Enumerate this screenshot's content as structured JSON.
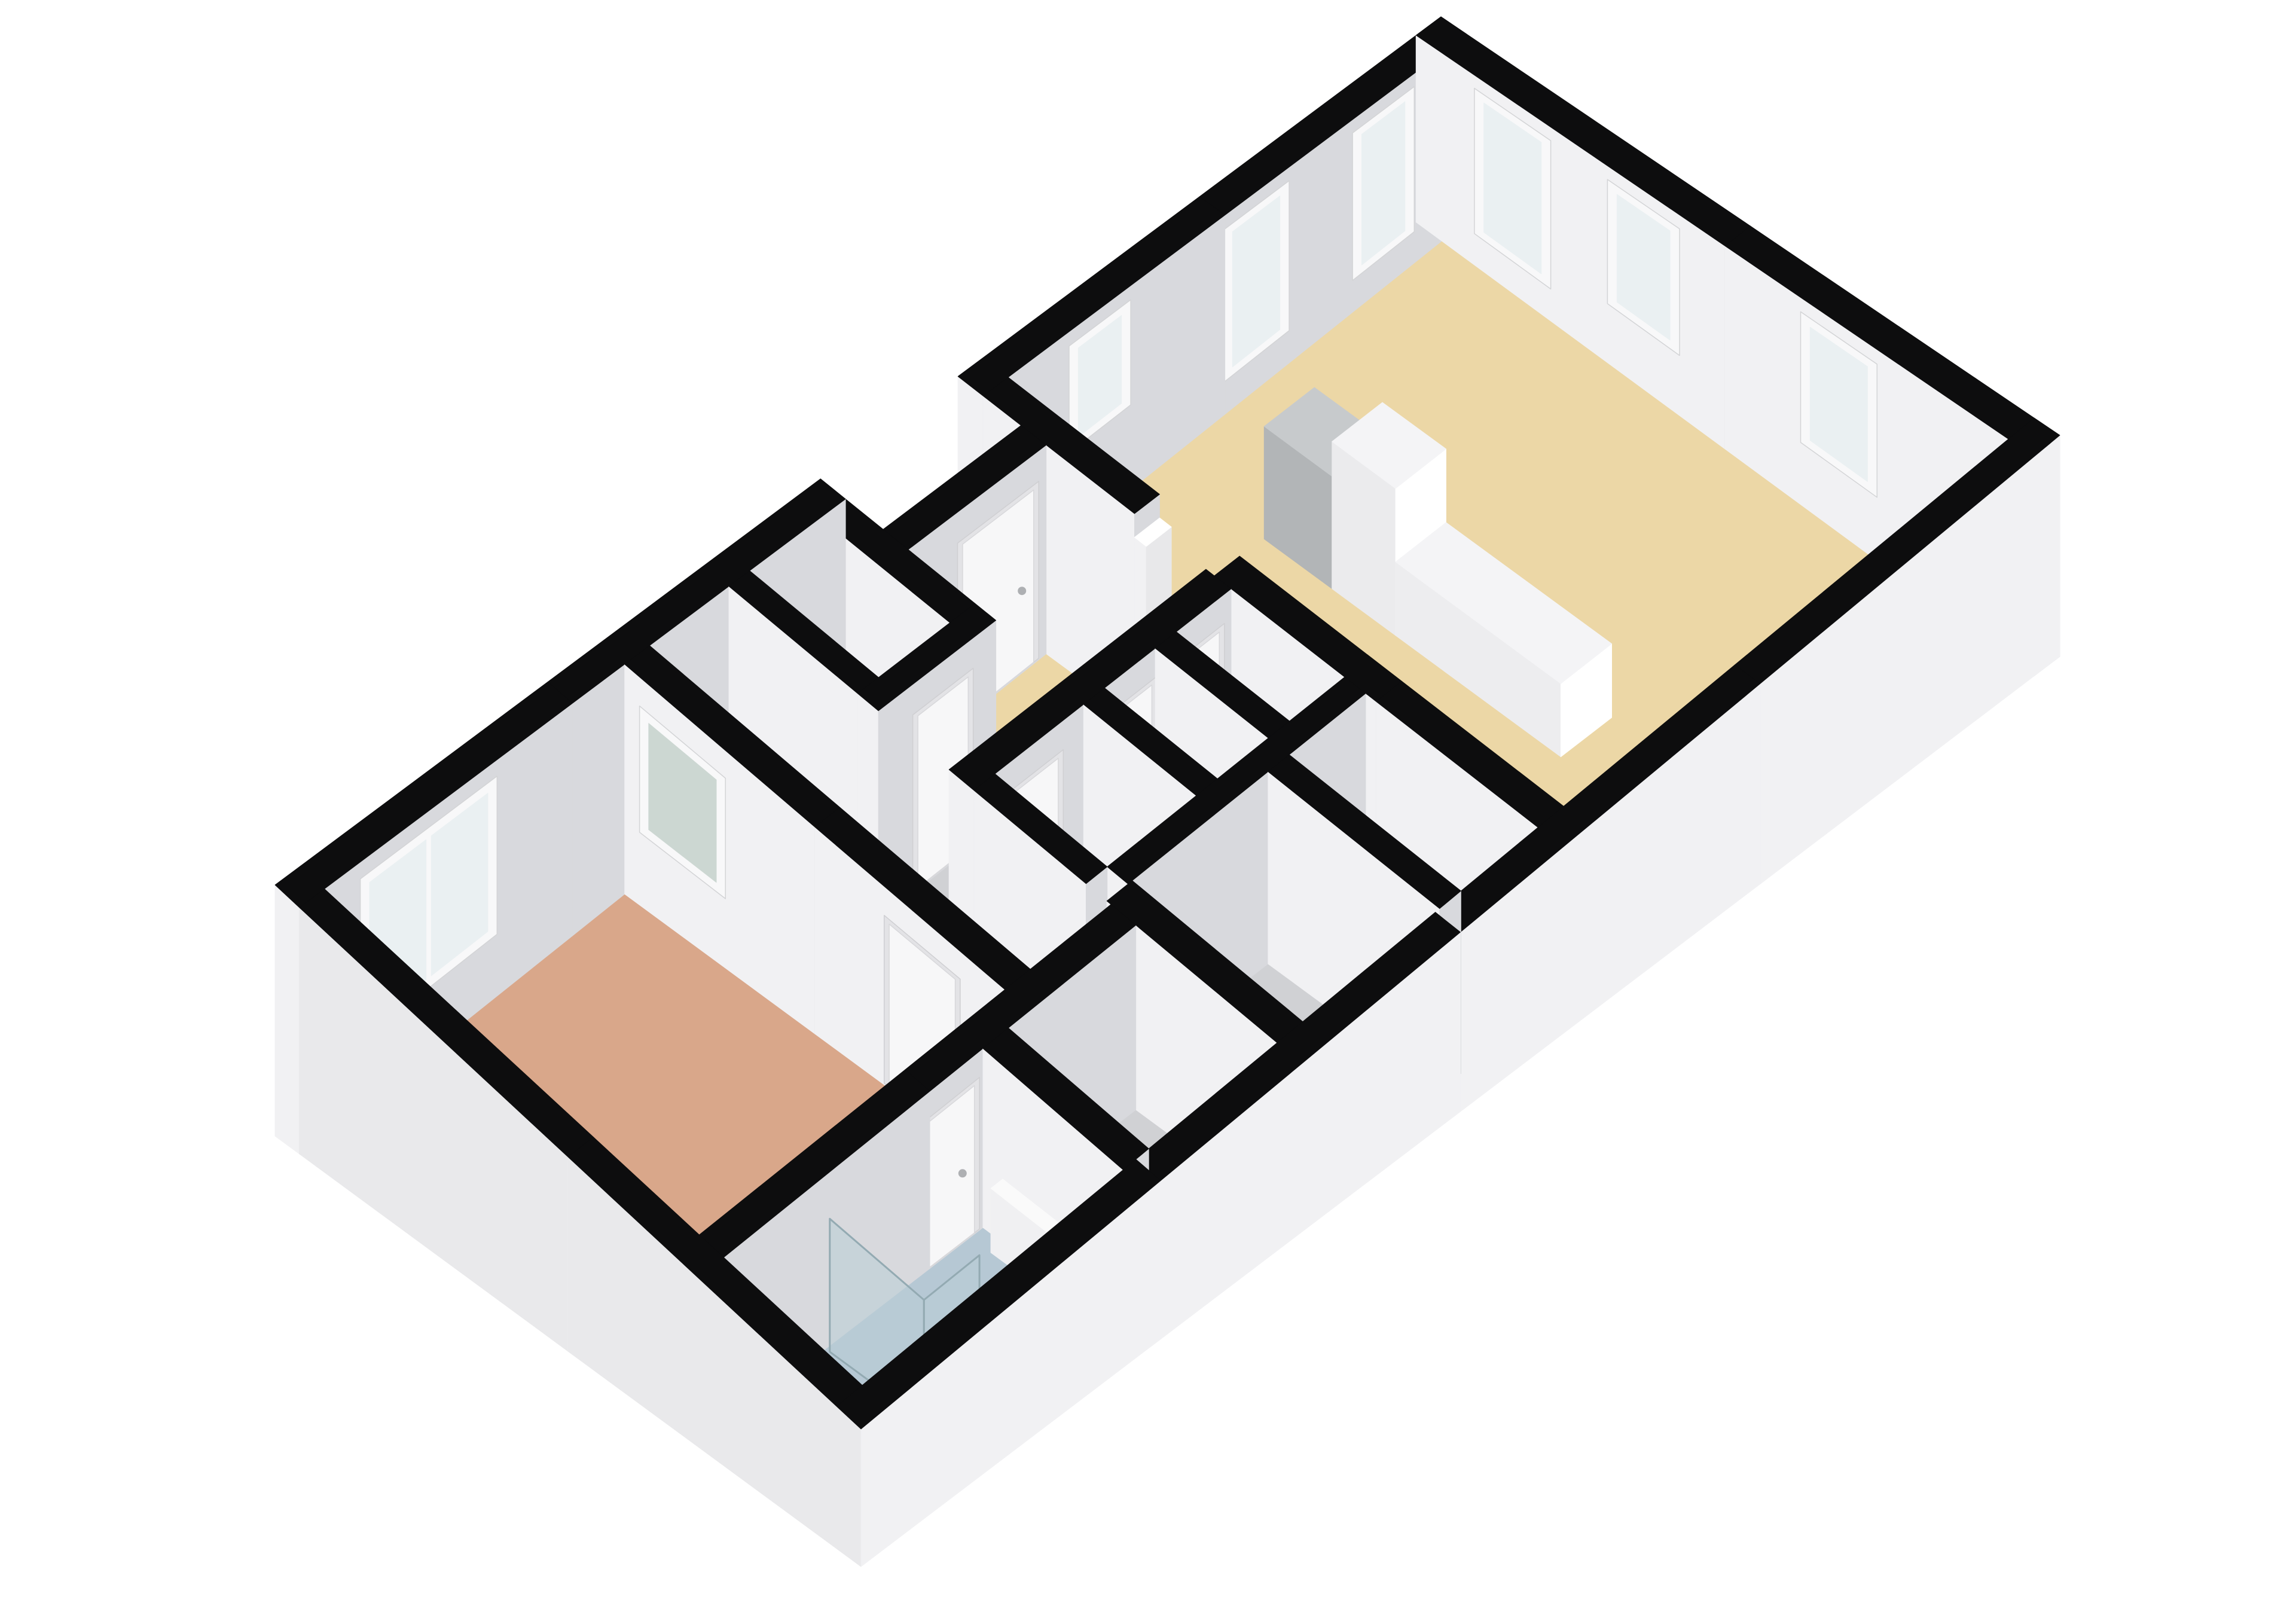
{
  "floorplan": {
    "description": "3D isometric floor plan of an apartment, viewed from above. Black wall tops, white interior walls, light gray exterior wall faces on a white background. Large living room with beige floor, kitchen counter units and five windows; entry hall with beige floor behind a recessed front-door notch; central cluster of gray-floored rooms (hallway, toilet, storage, boiler closet with two orange control knobs); bathroom with light blue floor, glass shower screen, toilet and white radiator; bedroom with salmon floor, a large two-pane exterior window and a frosted interior window.",
    "building": {
      "width_m": 14,
      "depth_m": 7.2,
      "wall_height_m": 2.6,
      "wall_thickness_m": 0.3
    },
    "projection": {
      "W": [
        460,
        1480
      ],
      "N": [
        2410,
        28
      ],
      "E": [
        3445,
        728
      ],
      "S": [
        1440,
        2390
      ],
      "drop": [
        420,
        310,
        370,
        230
      ]
    },
    "colors": {
      "background": "#ffffff",
      "wall_top": "#0d0d0e",
      "wall_face_left": "#f1f1f3",
      "wall_face_front": "#d8d9dd",
      "ext_face_left": "#e9e9eb",
      "ext_face_front": "#f1f1f3",
      "floor_beige": "#ecd7a6",
      "floor_salmon": "#d9a78a",
      "floor_blue": "#b6c8d4",
      "floor_gray": "#d0d1d4",
      "window_frame": "#f8f8f9",
      "window_glass": "#eaf0f2",
      "frosted_glass": "#ccd7d2",
      "door_frame": "#e3e3e6",
      "door_leaf": "#f7f7f8",
      "handle": "#aeb0b3",
      "boiler": "#6c7072",
      "knob": "#dd5226",
      "vent": "#3a3d3f",
      "shower_glass": "rgba(185,206,213,0.55)",
      "glass_edge": "#93aab2",
      "fixture_white": "#ffffff",
      "fixture_stroke": "#c6c6c9"
    },
    "rooms": [
      {
        "name": "bedroom",
        "rect": [
          0.3,
          0.3,
          3.9,
          4.9
        ],
        "color_key": "floor_salmon"
      },
      {
        "name": "corridor",
        "rect": [
          4.2,
          0.3,
          5.15,
          4.9
        ],
        "color_key": "floor_gray"
      },
      {
        "name": "hall-north",
        "rect": [
          5.4,
          0.3,
          6.25,
          1.85
        ],
        "color_key": "floor_gray"
      },
      {
        "name": "entry-hall",
        "rect": [
          6.55,
          1.05,
          8.2,
          2.1
        ],
        "color_key": "floor_beige"
      },
      {
        "name": "hall-strip",
        "rect": [
          5.15,
          2.1,
          8.2,
          2.95
        ],
        "color_key": "floor_gray"
      },
      {
        "name": "toilet-room",
        "rect": [
          5.4,
          3.25,
          6.45,
          4.6
        ],
        "color_key": "floor_gray"
      },
      {
        "name": "boiler-closet",
        "rect": [
          6.7,
          3.25,
          7.3,
          4.6
        ],
        "color_key": "floor_gray"
      },
      {
        "name": "storage",
        "rect": [
          7.55,
          3.25,
          8.2,
          4.6
        ],
        "color_key": "floor_gray"
      },
      {
        "name": "bathroom",
        "rect": [
          0.3,
          5.2,
          3.35,
          6.9
        ],
        "color_key": "floor_blue"
      },
      {
        "name": "room-south-mid",
        "rect": [
          3.65,
          5.2,
          5.15,
          6.9
        ],
        "color_key": "floor_gray"
      },
      {
        "name": "room-x1",
        "rect": [
          5.45,
          4.85,
          7.05,
          6.9
        ],
        "color_key": "floor_gray"
      },
      {
        "name": "room-x2",
        "rect": [
          7.3,
          4.85,
          8.2,
          6.9
        ],
        "color_key": "floor_gray"
      },
      {
        "name": "living-room",
        "rect": [
          8.5,
          0.3,
          13.7,
          6.9
        ],
        "color_key": "floor_beige"
      }
    ],
    "walls": [
      {
        "name": "ext-nw-left",
        "rect": [
          0,
          0,
          6.55,
          0.3
        ],
        "overlays": [
          {
            "type": "window",
            "face": "front",
            "u1": 0.8,
            "u2": 2.3,
            "z1": 0.75,
            "z2": 2.35,
            "panes": 2
          }
        ]
      },
      {
        "name": "ext-notch-left",
        "rect": [
          6.25,
          0.3,
          6.55,
          1.85
        ]
      },
      {
        "name": "ext-notch-front",
        "rect": [
          6.55,
          0.75,
          8.2,
          1.05
        ],
        "overlays": [
          {
            "type": "door",
            "face": "front",
            "u1": 7.2,
            "u2": 8.05
          }
        ]
      },
      {
        "name": "ext-nw-right",
        "rect": [
          8.2,
          0,
          14,
          0.3
        ],
        "overlays": [
          {
            "type": "window",
            "face": "front",
            "u1": 9.3,
            "u2": 9.9,
            "z1": 1.15,
            "z2": 2.35
          },
          {
            "type": "window",
            "face": "front",
            "u1": 11.15,
            "u2": 11.8,
            "z1": 0.5,
            "z2": 2.35
          },
          {
            "type": "window",
            "face": "front",
            "u1": 12.7,
            "u2": 13.3,
            "z1": 0.5,
            "z2": 2.35
          }
        ]
      },
      {
        "name": "ext-ne",
        "rect": [
          13.7,
          0,
          14,
          7.2
        ],
        "overlays": [
          {
            "type": "window",
            "face": "left",
            "u1": 0.75,
            "u2": 1.5,
            "z1": 0.5,
            "z2": 2.35
          },
          {
            "type": "window",
            "face": "left",
            "u1": 2.3,
            "u2": 3.0,
            "z1": 0.85,
            "z2": 2.35
          },
          {
            "type": "window",
            "face": "left",
            "u1": 4.55,
            "u2": 5.3,
            "z1": 0.85,
            "z2": 2.35
          }
        ]
      },
      {
        "name": "ext-se",
        "rect": [
          0,
          6.9,
          14,
          7.2
        ],
        "ext": true
      },
      {
        "name": "ext-sw",
        "rect": [
          0,
          0.3,
          0.3,
          6.9
        ],
        "ext": true
      },
      {
        "name": "int-bedroom-east",
        "rect": [
          3.9,
          0.3,
          4.2,
          4.9
        ],
        "overlays": [
          {
            "type": "frosted",
            "face": "left",
            "u1": 0.55,
            "u2": 1.45,
            "z1": 0.9,
            "z2": 2.2
          },
          {
            "type": "door",
            "face": "left",
            "u1": 3.5,
            "u2": 4.3
          }
        ]
      },
      {
        "name": "int-hall-west",
        "rect": [
          5.15,
          0.3,
          5.4,
          1.85
        ]
      },
      {
        "name": "int-hall-south",
        "rect": [
          5.15,
          1.85,
          6.55,
          2.1
        ],
        "overlays": [
          {
            "type": "door",
            "face": "front",
            "u1": 5.62,
            "u2": 6.22
          }
        ]
      },
      {
        "name": "int-strip-south",
        "rect": [
          5.15,
          2.95,
          8.2,
          3.25
        ],
        "overlays": [
          {
            "type": "door",
            "face": "front",
            "u1": 5.55,
            "u2": 6.15
          },
          {
            "type": "door",
            "face": "front",
            "u1": 6.72,
            "u2": 7.26
          },
          {
            "type": "door",
            "face": "front",
            "u1": 7.52,
            "u2": 8.06
          }
        ]
      },
      {
        "name": "int-corridor-east",
        "rect": [
          5.15,
          3.25,
          5.4,
          4.6
        ]
      },
      {
        "name": "int-div-toilet-boiler",
        "rect": [
          6.45,
          3.25,
          6.7,
          4.6
        ]
      },
      {
        "name": "int-div-boiler-storage",
        "rect": [
          7.3,
          3.25,
          7.55,
          4.6
        ]
      },
      {
        "name": "int-rooms-south",
        "rect": [
          5.4,
          4.6,
          8.2,
          4.85
        ]
      },
      {
        "name": "int-bed-south",
        "rect": [
          0.3,
          4.9,
          5.15,
          5.2
        ],
        "overlays": [
          {
            "type": "door",
            "face": "front",
            "u1": 2.55,
            "u2": 3.25
          }
        ]
      },
      {
        "name": "int-bath-east",
        "rect": [
          3.35,
          5.2,
          3.65,
          6.9
        ]
      },
      {
        "name": "int-x-west",
        "rect": [
          5.15,
          4.85,
          5.45,
          6.9
        ]
      },
      {
        "name": "int-div-x",
        "rect": [
          7.05,
          4.85,
          7.3,
          6.9
        ]
      },
      {
        "name": "int-living-west-north",
        "rect": [
          8.2,
          0.3,
          8.5,
          2.1
        ]
      },
      {
        "name": "int-living-west-south",
        "rect": [
          8.2,
          3.05,
          8.5,
          6.9
        ]
      }
    ],
    "furniture": [
      {
        "name": "kitchen-unit-gray",
        "rect": [
          10.35,
          1.5,
          10.95,
          2.3
        ],
        "h": 1.45,
        "top": "#c7cacc",
        "left": "#b2b5b7",
        "front": "#d0d3d5"
      },
      {
        "name": "kitchen-tall-unit",
        "rect": [
          10.35,
          2.3,
          10.95,
          3.05
        ],
        "h": 1.9,
        "top": "#f4f4f6",
        "left": "#ebebed",
        "front": "#ffffff"
      },
      {
        "name": "kitchen-counter",
        "rect": [
          10.35,
          3.05,
          10.95,
          5.0
        ],
        "h": 0.95,
        "top": "#f4f4f6",
        "left": "#ededef",
        "front": "#ffffff"
      },
      {
        "name": "kitchen-low-unit",
        "rect": [
          11.7,
          6.1,
          12.6,
          6.85
        ],
        "h": 0.9,
        "top": "#f4f4f6",
        "left": "#ededef",
        "front": "#ffffff"
      },
      {
        "name": "living-door-post-north",
        "rect": [
          8.2,
          2.1,
          8.5,
          2.24
        ],
        "h": 2.3,
        "top": "#ffffff",
        "left": "#f1f1f3",
        "front": "#e8e8ea"
      },
      {
        "name": "living-door-post-south",
        "rect": [
          8.2,
          2.91,
          8.5,
          3.05
        ],
        "h": 2.3,
        "top": "#ffffff",
        "left": "#f1f1f3",
        "front": "#e8e8ea"
      },
      {
        "name": "bathroom-radiator",
        "rect": [
          3.2,
          5.45,
          3.34,
          6.25
        ],
        "h": 0.95,
        "top": "#fafafa",
        "left": "#f0f0f2",
        "front": "#ffffff"
      },
      {
        "name": "toilet-tank",
        "rect": [
          1.55,
          6.6,
          1.95,
          6.85
        ],
        "h": 0.78,
        "top": "#fbfbfc",
        "left": "#f1f1f3",
        "front": "#ffffff"
      },
      {
        "name": "boiler-unit",
        "rect": [
          7.0,
          3.4,
          7.28,
          4.35
        ],
        "h": 1.5,
        "top": "#7a7e80",
        "left": "#6c7072",
        "front": "#5e6264",
        "overlays": [
          {
            "type": "knobs",
            "face": "left",
            "pts": [
              [
                3.62,
                1.0
              ],
              [
                3.85,
                1.0
              ]
            ]
          },
          {
            "type": "vents",
            "face": "left",
            "pts": [
              [
                3.98,
                1.2
              ],
              [
                4.1,
                1.25
              ],
              [
                4.22,
                1.3
              ]
            ]
          }
        ]
      }
    ],
    "shower_glass": [
      {
        "name": "shower-screen-long",
        "from": [
          1.5,
          5.25
        ],
        "to": [
          1.5,
          6.4
        ],
        "h": 2.0
      },
      {
        "name": "shower-screen-return",
        "from": [
          1.5,
          6.4
        ],
        "to": [
          2.15,
          6.4
        ],
        "h": 2.0
      }
    ],
    "toilet": {
      "name": "toilet-bowl",
      "at": [
        1.75,
        6.38
      ],
      "rx": 40,
      "ry": 26
    }
  }
}
